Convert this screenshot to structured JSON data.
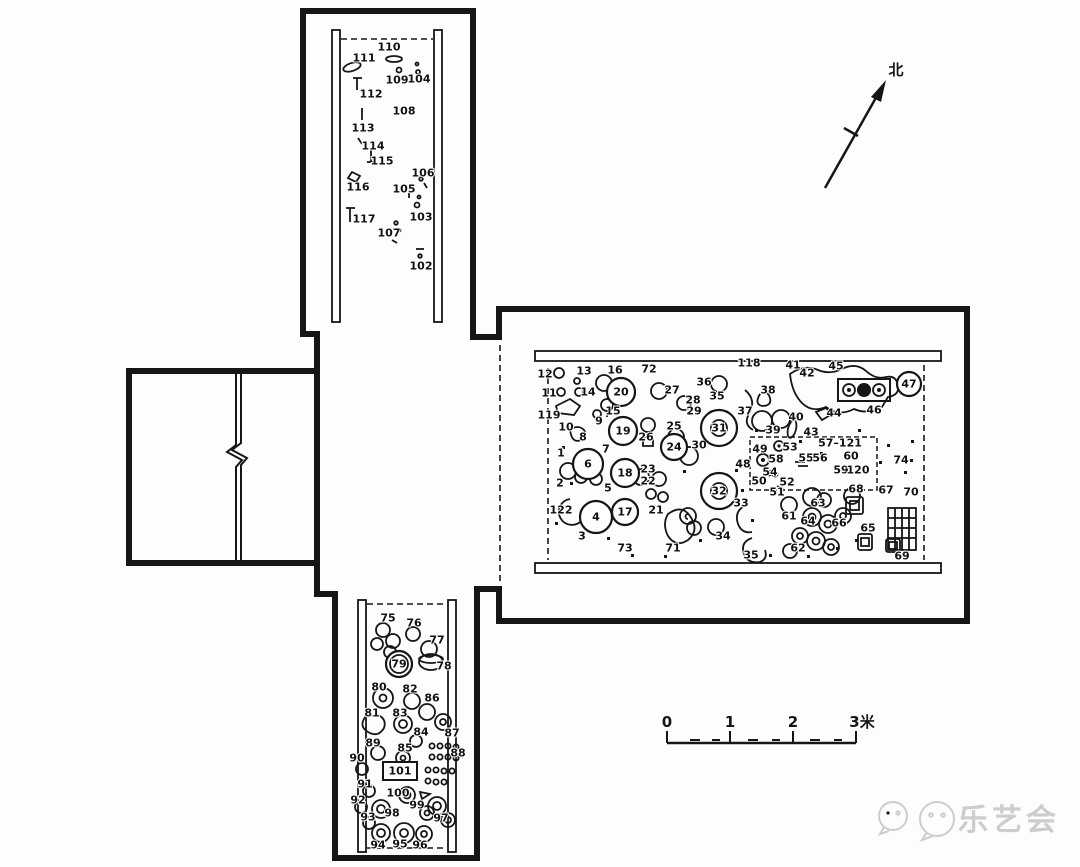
{
  "north_arrow": {
    "label": "北"
  },
  "scale_bar": {
    "ticks": [
      "0",
      "1",
      "2",
      "3米"
    ]
  },
  "watermark": {
    "text": "乐艺会"
  },
  "areas": {
    "north_corridor": {
      "labels": [
        {
          "n": "110",
          "x": 389,
          "y": 47
        },
        {
          "n": "111",
          "x": 364,
          "y": 58
        },
        {
          "n": "109",
          "x": 397,
          "y": 80
        },
        {
          "n": "104",
          "x": 419,
          "y": 79
        },
        {
          "n": "112",
          "x": 371,
          "y": 94
        },
        {
          "n": "108",
          "x": 404,
          "y": 111
        },
        {
          "n": "113",
          "x": 363,
          "y": 128
        },
        {
          "n": "114",
          "x": 373,
          "y": 146
        },
        {
          "n": "115",
          "x": 382,
          "y": 161
        },
        {
          "n": "116",
          "x": 358,
          "y": 187
        },
        {
          "n": "106",
          "x": 423,
          "y": 173
        },
        {
          "n": "105",
          "x": 404,
          "y": 189
        },
        {
          "n": "103",
          "x": 421,
          "y": 217
        },
        {
          "n": "117",
          "x": 364,
          "y": 219
        },
        {
          "n": "107",
          "x": 389,
          "y": 233
        },
        {
          "n": "102",
          "x": 421,
          "y": 266
        }
      ]
    },
    "main_chamber": {
      "labels": [
        {
          "n": "12",
          "x": 545,
          "y": 374
        },
        {
          "n": "13",
          "x": 584,
          "y": 371
        },
        {
          "n": "16",
          "x": 615,
          "y": 370
        },
        {
          "n": "72",
          "x": 649,
          "y": 369
        },
        {
          "n": "11",
          "x": 549,
          "y": 393
        },
        {
          "n": "14",
          "x": 588,
          "y": 392
        },
        {
          "n": "20",
          "x": 621,
          "y": 392,
          "c": 14
        },
        {
          "n": "27",
          "x": 672,
          "y": 390
        },
        {
          "n": "36",
          "x": 704,
          "y": 382
        },
        {
          "n": "38",
          "x": 768,
          "y": 390
        },
        {
          "n": "28",
          "x": 693,
          "y": 400
        },
        {
          "n": "35",
          "x": 717,
          "y": 396
        },
        {
          "n": "29",
          "x": 694,
          "y": 411
        },
        {
          "n": "119",
          "x": 549,
          "y": 415
        },
        {
          "n": "15",
          "x": 613,
          "y": 411
        },
        {
          "n": "9",
          "x": 599,
          "y": 421
        },
        {
          "n": "10",
          "x": 566,
          "y": 427
        },
        {
          "n": "8",
          "x": 583,
          "y": 437
        },
        {
          "n": "19",
          "x": 623,
          "y": 431,
          "c": 14
        },
        {
          "n": "26",
          "x": 646,
          "y": 437
        },
        {
          "n": "25",
          "x": 674,
          "y": 426
        },
        {
          "n": "24",
          "x": 674,
          "y": 447,
          "c": 13
        },
        {
          "n": "30",
          "x": 699,
          "y": 445
        },
        {
          "n": "31",
          "x": 719,
          "y": 428,
          "c": 18,
          "ic": 8
        },
        {
          "n": "1",
          "x": 561,
          "y": 453
        },
        {
          "n": "7",
          "x": 606,
          "y": 449
        },
        {
          "n": "6",
          "x": 588,
          "y": 464,
          "c": 15
        },
        {
          "n": "18",
          "x": 625,
          "y": 473,
          "c": 14
        },
        {
          "n": "23",
          "x": 648,
          "y": 469
        },
        {
          "n": "22",
          "x": 648,
          "y": 481
        },
        {
          "n": "2",
          "x": 560,
          "y": 483
        },
        {
          "n": "5",
          "x": 608,
          "y": 488
        },
        {
          "n": "122",
          "x": 561,
          "y": 510
        },
        {
          "n": "4",
          "x": 596,
          "y": 517,
          "c": 16
        },
        {
          "n": "17",
          "x": 625,
          "y": 512,
          "c": 13
        },
        {
          "n": "21",
          "x": 656,
          "y": 510
        },
        {
          "n": "32",
          "x": 719,
          "y": 491,
          "c": 18,
          "ic": 8
        },
        {
          "n": "33",
          "x": 741,
          "y": 503
        },
        {
          "n": "3",
          "x": 582,
          "y": 536
        },
        {
          "n": "73",
          "x": 625,
          "y": 548
        },
        {
          "n": "71",
          "x": 673,
          "y": 548
        },
        {
          "n": "34",
          "x": 723,
          "y": 536
        },
        {
          "n": "118",
          "x": 749,
          "y": 363
        },
        {
          "n": "41",
          "x": 793,
          "y": 365
        },
        {
          "n": "45",
          "x": 836,
          "y": 366
        },
        {
          "n": "42",
          "x": 807,
          "y": 373
        },
        {
          "n": "47",
          "x": 909,
          "y": 384,
          "c": 12
        },
        {
          "n": "37",
          "x": 745,
          "y": 411
        },
        {
          "n": "40",
          "x": 796,
          "y": 417
        },
        {
          "n": "44",
          "x": 834,
          "y": 413
        },
        {
          "n": "46",
          "x": 874,
          "y": 410
        },
        {
          "n": "39",
          "x": 773,
          "y": 430
        },
        {
          "n": "43",
          "x": 811,
          "y": 432
        },
        {
          "n": "48",
          "x": 743,
          "y": 464
        },
        {
          "n": "49",
          "x": 760,
          "y": 449
        },
        {
          "n": "53",
          "x": 790,
          "y": 447
        },
        {
          "n": "57–121",
          "x": 840,
          "y": 443
        },
        {
          "n": "58",
          "x": 776,
          "y": 459
        },
        {
          "n": "55",
          "x": 806,
          "y": 458
        },
        {
          "n": "56",
          "x": 820,
          "y": 458
        },
        {
          "n": "60",
          "x": 851,
          "y": 456
        },
        {
          "n": "59",
          "x": 841,
          "y": 470
        },
        {
          "n": "120",
          "x": 858,
          "y": 470
        },
        {
          "n": "50",
          "x": 759,
          "y": 481
        },
        {
          "n": "54",
          "x": 770,
          "y": 472
        },
        {
          "n": "52",
          "x": 787,
          "y": 482
        },
        {
          "n": "51",
          "x": 777,
          "y": 492
        },
        {
          "n": "74",
          "x": 901,
          "y": 460
        },
        {
          "n": "61",
          "x": 789,
          "y": 516
        },
        {
          "n": "63",
          "x": 818,
          "y": 503
        },
        {
          "n": "64",
          "x": 808,
          "y": 521
        },
        {
          "n": "66",
          "x": 839,
          "y": 523
        },
        {
          "n": "65",
          "x": 868,
          "y": 528
        },
        {
          "n": "62",
          "x": 798,
          "y": 548
        },
        {
          "n": "67",
          "x": 886,
          "y": 490
        },
        {
          "n": "68",
          "x": 856,
          "y": 489
        },
        {
          "n": "70",
          "x": 911,
          "y": 492
        },
        {
          "n": "69",
          "x": 902,
          "y": 556
        },
        {
          "n": "35",
          "x": 751,
          "y": 555
        }
      ]
    },
    "south_corridor": {
      "labels": [
        {
          "n": "75",
          "x": 388,
          "y": 618
        },
        {
          "n": "76",
          "x": 414,
          "y": 623
        },
        {
          "n": "77",
          "x": 437,
          "y": 640
        },
        {
          "n": "79",
          "x": 399,
          "y": 664,
          "c": 13,
          "ic": 9
        },
        {
          "n": "78",
          "x": 444,
          "y": 666
        },
        {
          "n": "80",
          "x": 379,
          "y": 687
        },
        {
          "n": "82",
          "x": 410,
          "y": 689
        },
        {
          "n": "86",
          "x": 432,
          "y": 698
        },
        {
          "n": "81",
          "x": 372,
          "y": 713
        },
        {
          "n": "83",
          "x": 400,
          "y": 713
        },
        {
          "n": "84",
          "x": 421,
          "y": 732
        },
        {
          "n": "87",
          "x": 452,
          "y": 733
        },
        {
          "n": "89",
          "x": 373,
          "y": 743
        },
        {
          "n": "85",
          "x": 405,
          "y": 748
        },
        {
          "n": "88",
          "x": 458,
          "y": 753
        },
        {
          "n": "90",
          "x": 357,
          "y": 758
        },
        {
          "n": "101",
          "x": 400,
          "y": 771,
          "box": [
            34,
            18
          ]
        },
        {
          "n": "91",
          "x": 365,
          "y": 784
        },
        {
          "n": "100",
          "x": 398,
          "y": 793
        },
        {
          "n": "92",
          "x": 358,
          "y": 800
        },
        {
          "n": "99",
          "x": 417,
          "y": 805
        },
        {
          "n": "98",
          "x": 392,
          "y": 813
        },
        {
          "n": "93",
          "x": 368,
          "y": 817
        },
        {
          "n": "97",
          "x": 441,
          "y": 818
        },
        {
          "n": "94",
          "x": 378,
          "y": 845
        },
        {
          "n": "95",
          "x": 400,
          "y": 844
        },
        {
          "n": "96",
          "x": 420,
          "y": 845
        }
      ]
    }
  }
}
